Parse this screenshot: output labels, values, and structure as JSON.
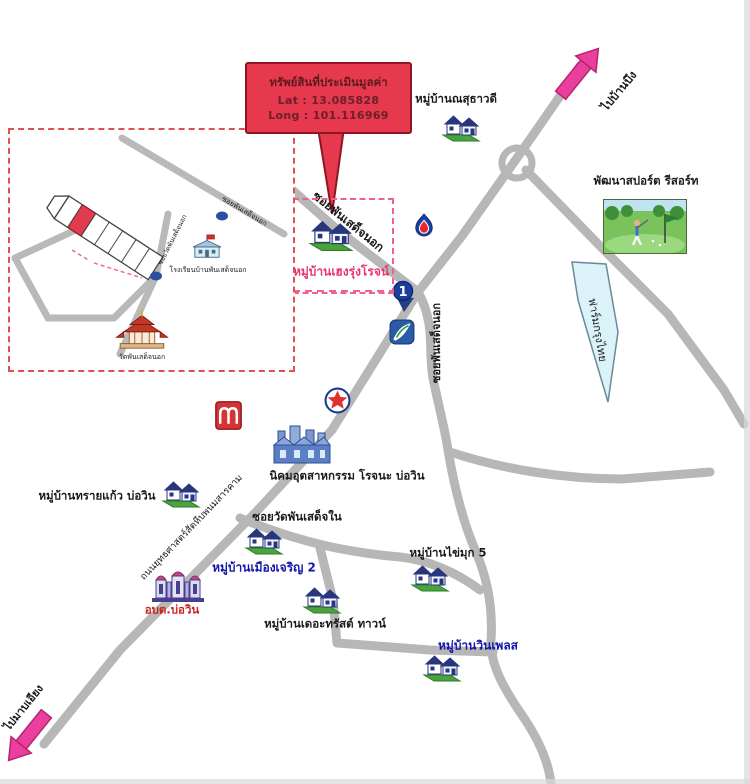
{
  "callout": {
    "title": "ทรัพย์สินที่ประเมินมูลค่า",
    "lat": "Lat : 13.085828",
    "long": "Long : 101.116969"
  },
  "directions": {
    "to_ban_bueng": "ไปบ้านบึง",
    "to_map_iang": "ไปมาบเอียง"
  },
  "roads": {
    "soi_phan_sadet_nok_upper": "ซอยพันเสด็จนอก",
    "soi_phan_sadet_nok_side": "ซอยพันเสด็จนอก",
    "soi_wat_phan_sadet_nai": "ซอยวัดพันเสด็จใน",
    "yutthasat": "ถนนยุทธศาสตร์สัตหีบพนมสารคาม"
  },
  "places": {
    "nathawadee": "หมู่บ้านณสุธาวดี",
    "heng_rung_rot": "หมู่บ้านเฮงรุ่งโรจน์",
    "pattana_sport_resort": "พัฒนาสปอร์ต รีสอร์ท",
    "krungthai_farm": "ฟาร์มกรุงไทย",
    "rojana_industrial": "นิคมอุตสาหกรรม โรจนะ บ่อวิน",
    "sai_kaew": "หมู่บ้านทรายแก้ว บ่อวิน",
    "muang_charoen_2": "หมู่บ้านเมืองเจริญ 2",
    "obt_bo_win": "อบต.บ่อวิน",
    "the_trust_town": "หมู่บ้านเดอะทรัสต์ ทาวน์",
    "khai_muk_5": "หมู่บ้านไข่มุก 5",
    "win_place": "หมู่บ้านวินเพลส"
  },
  "markers": {
    "route_1": "1"
  },
  "inset": {
    "school": "โรงเรียนบ้านพันเสด็จนอก",
    "temple": "วัดพันเสด็จนอก",
    "road_main": "ซอยพันเสด็จนอก",
    "road_cross": "ซอยวัดพันเสด็จนอก"
  },
  "colors": {
    "road": "#b7b7b7",
    "callout_red": "#e6394e",
    "arrow_pink": "#ea3f9e",
    "label_blue": "#1515a8",
    "label_pink": "#e8356e",
    "label_red": "#cc2222",
    "farm_banner": "#dbf2f8"
  }
}
